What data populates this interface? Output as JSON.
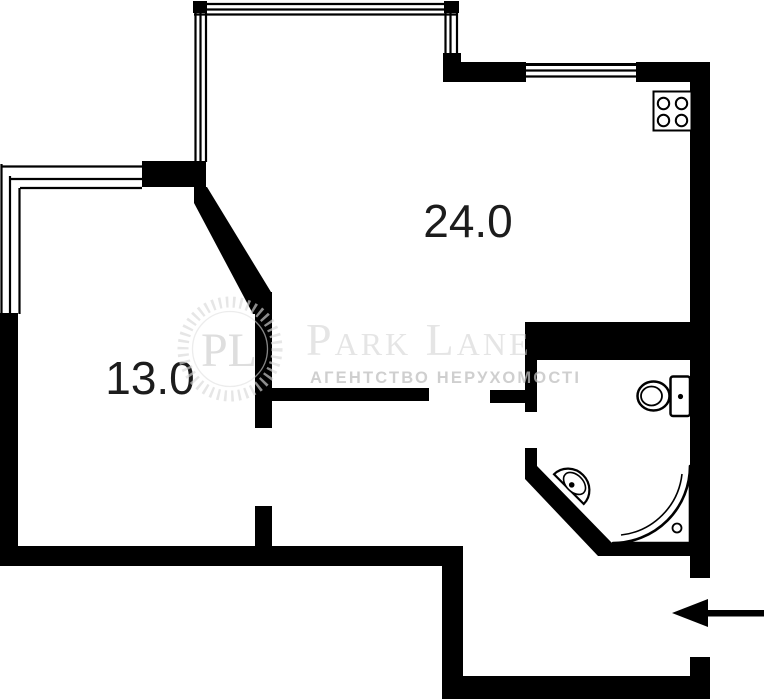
{
  "plan": {
    "type": "apartment-floor-plan",
    "rooms": [
      {
        "id": "room-24",
        "area_label": "24.0"
      },
      {
        "id": "room-13",
        "area_label": "13.0"
      }
    ],
    "watermark": {
      "monogram": "PL",
      "brand": "Park Lane",
      "subtitle": "АГЕНТСТВО НЕРУХОМОСТІ"
    },
    "fixtures": [
      {
        "id": "stove",
        "label": "4-burner stove"
      },
      {
        "id": "toilet",
        "label": "toilet"
      },
      {
        "id": "corner-sink",
        "label": "corner sink"
      },
      {
        "id": "corner-shower",
        "label": "corner shower tray"
      }
    ],
    "entrance": {
      "symbol": "left-arrow"
    },
    "colors": {
      "wall": "#000000",
      "background": "#ffffff",
      "room_label": "#1c1c1c",
      "watermark": "#d6d6d6",
      "watermark_subtitle": "#c0c0c0"
    }
  }
}
